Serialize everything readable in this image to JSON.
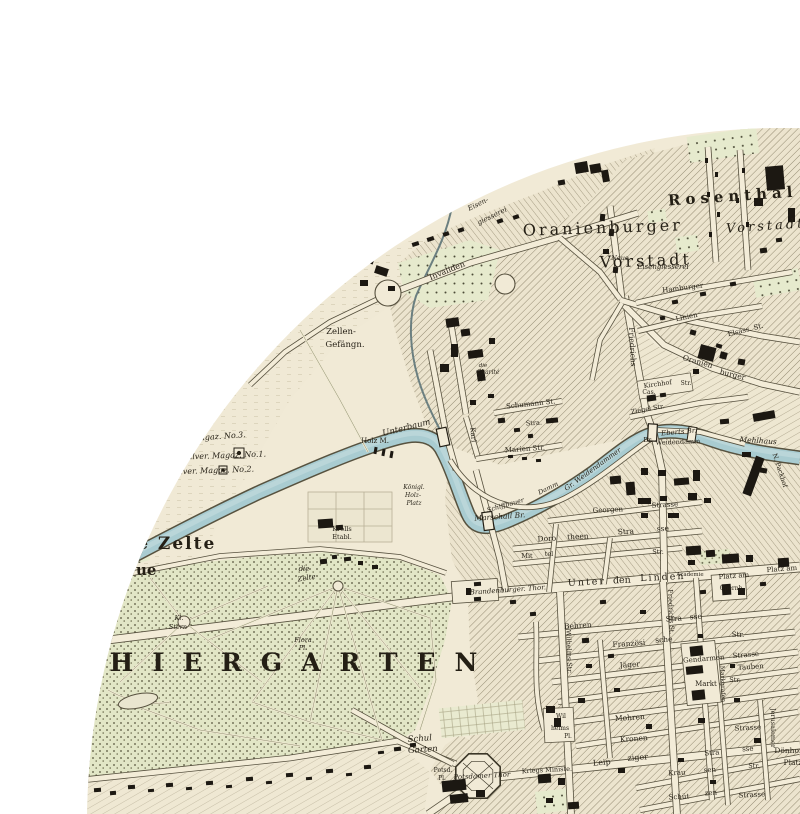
{
  "map": {
    "kind": "historical-city-map-circular-crop",
    "colors": {
      "paper": "#f1ead6",
      "ink": "#241f15",
      "water": "#a9ccd1",
      "water_edge": "#57523f",
      "park_green": "#e2e6c8",
      "hatch": "#847b63",
      "street_fill": "#f3ecd8",
      "street_edge": "#56503e",
      "page_background": "#ffffff"
    },
    "labels": [
      {
        "t": "Rosenthal",
        "x": 733,
        "y": 201,
        "s": 15,
        "r": -4,
        "f": "b",
        "ls": 5
      },
      {
        "t": "Vorstadt",
        "x": 766,
        "y": 230,
        "s": 13,
        "r": -4,
        "f": "i",
        "ls": 3
      },
      {
        "t": "Oranienburger",
        "x": 603,
        "y": 233,
        "s": 16,
        "r": -2,
        "ls": 3
      },
      {
        "t": "Vorstadt",
        "x": 646,
        "y": 266,
        "s": 16,
        "r": -2,
        "ls": 3
      },
      {
        "t": "Neue",
        "x": 620,
        "y": 260,
        "s": 6.5,
        "f": "i"
      },
      {
        "t": "Eisengiesserei",
        "x": 663,
        "y": 269,
        "s": 7,
        "f": "i"
      },
      {
        "t": "THIERGARTEN",
        "x": 72,
        "y": 671,
        "s": 25,
        "f": "b",
        "ls": 19,
        "a": "s"
      },
      {
        "t": "Die Zelte",
        "x": 112,
        "y": 549,
        "s": 17,
        "f": "b",
        "a": "s",
        "ls": 2
      },
      {
        "t": "ue",
        "x": 136,
        "y": 575,
        "s": 15,
        "f": "b",
        "a": "s"
      },
      {
        "t": "die",
        "x": 304,
        "y": 571,
        "s": 7,
        "f": "i"
      },
      {
        "t": "Zelte",
        "x": 307,
        "y": 580,
        "s": 7,
        "f": "i",
        "r": -10
      },
      {
        "t": "Zellen-",
        "x": 341,
        "y": 334,
        "s": 8.5
      },
      {
        "t": "Gefängn.",
        "x": 345,
        "y": 347,
        "s": 8.5
      },
      {
        "t": "Eisen-",
        "x": 479,
        "y": 206,
        "s": 7,
        "f": "i",
        "r": -26
      },
      {
        "t": "giesserei",
        "x": 493,
        "y": 218,
        "s": 7,
        "f": "i",
        "r": -26
      },
      {
        "t": "Invaliden",
        "x": 448,
        "y": 273,
        "s": 8,
        "r": -22
      },
      {
        "t": "Magaz. No.3.",
        "x": 219,
        "y": 439,
        "s": 8,
        "f": "i",
        "r": -4
      },
      {
        "t": "Pulver. Magaz. No.1.",
        "x": 224,
        "y": 458,
        "s": 8,
        "f": "i",
        "r": -2
      },
      {
        "t": "Pulver. Magaz. No.2.",
        "x": 212,
        "y": 473,
        "s": 8,
        "f": "i",
        "r": -2
      },
      {
        "t": "Unterbaum",
        "x": 407,
        "y": 430,
        "s": 8.5,
        "f": "i",
        "r": -14
      },
      {
        "t": "Holz M.",
        "x": 375,
        "y": 443,
        "s": 7
      },
      {
        "t": "Königl.",
        "x": 414,
        "y": 489,
        "s": 6,
        "f": "i"
      },
      {
        "t": "Holz-",
        "x": 413,
        "y": 497,
        "s": 6,
        "f": "i"
      },
      {
        "t": "Platz",
        "x": 414,
        "y": 505,
        "s": 6,
        "f": "i"
      },
      {
        "t": "Marschall Br.",
        "x": 500,
        "y": 519,
        "s": 7.5,
        "f": "i",
        "r": -4
      },
      {
        "t": "Krolls",
        "x": 342,
        "y": 531,
        "s": 6.5
      },
      {
        "t": "Etabl.",
        "x": 342,
        "y": 539,
        "s": 6.5
      },
      {
        "t": "Kl.",
        "x": 179,
        "y": 620,
        "s": 6.5,
        "f": "i"
      },
      {
        "t": "Stern",
        "x": 178,
        "y": 629,
        "s": 6.5,
        "f": "i"
      },
      {
        "t": "Flora",
        "x": 303,
        "y": 642,
        "s": 6.5,
        "f": "i"
      },
      {
        "t": "Pl.",
        "x": 303,
        "y": 650,
        "s": 6.5,
        "f": "i"
      },
      {
        "t": "Schul",
        "x": 420,
        "y": 741,
        "s": 8.5,
        "f": "i",
        "r": -4
      },
      {
        "t": "Garten",
        "x": 423,
        "y": 752,
        "s": 8.5,
        "f": "i",
        "r": -4
      },
      {
        "t": "Potsdamer Thor",
        "x": 482,
        "y": 778,
        "s": 7,
        "f": "i",
        "r": -3
      },
      {
        "t": "Potsd.",
        "x": 443,
        "y": 772,
        "s": 6
      },
      {
        "t": "Pl.",
        "x": 442,
        "y": 780,
        "s": 6
      },
      {
        "t": "Leip",
        "x": 602,
        "y": 765,
        "s": 8,
        "r": -5
      },
      {
        "t": "ziger",
        "x": 638,
        "y": 760,
        "s": 8,
        "r": -5
      },
      {
        "t": "Stra",
        "x": 712,
        "y": 755,
        "s": 7,
        "r": -4
      },
      {
        "t": "sse",
        "x": 748,
        "y": 751,
        "s": 7,
        "r": -4
      },
      {
        "t": "Krau",
        "x": 677,
        "y": 775,
        "s": 7,
        "r": -3
      },
      {
        "t": "sen",
        "x": 710,
        "y": 772,
        "s": 7,
        "r": -3
      },
      {
        "t": "Str.",
        "x": 754,
        "y": 768,
        "s": 6.5
      },
      {
        "t": "Schüt",
        "x": 679,
        "y": 799,
        "s": 7,
        "r": -3
      },
      {
        "t": "zen",
        "x": 711,
        "y": 795,
        "s": 7,
        "r": -3
      },
      {
        "t": "Strasse",
        "x": 752,
        "y": 797,
        "s": 7,
        "r": -3
      },
      {
        "t": "Dönhofs",
        "x": 790,
        "y": 753,
        "s": 7.5
      },
      {
        "t": "Platz",
        "x": 793,
        "y": 765,
        "s": 7.5
      },
      {
        "t": "Jerusalemer",
        "x": 771,
        "y": 728,
        "s": 6.5,
        "r": 90
      },
      {
        "t": "Strasse",
        "x": 748,
        "y": 730,
        "s": 7,
        "r": -3
      },
      {
        "t": "Mohren",
        "x": 630,
        "y": 720,
        "s": 7.5,
        "r": -4
      },
      {
        "t": "Kronen",
        "x": 634,
        "y": 741,
        "s": 7.5,
        "r": -4
      },
      {
        "t": "Wil",
        "x": 561,
        "y": 718,
        "s": 6
      },
      {
        "t": "helms",
        "x": 560,
        "y": 730,
        "s": 6
      },
      {
        "t": "Pl.",
        "x": 568,
        "y": 738,
        "s": 6
      },
      {
        "t": "Kriegs Ministe.",
        "x": 547,
        "y": 772,
        "s": 6.5,
        "r": -3
      },
      {
        "t": "Behren",
        "x": 578,
        "y": 628,
        "s": 7.5,
        "r": -4
      },
      {
        "t": "Stra",
        "x": 674,
        "y": 621,
        "s": 7.5,
        "r": -4
      },
      {
        "t": "sse",
        "x": 696,
        "y": 619,
        "s": 7.5,
        "r": -4
      },
      {
        "t": "Französi",
        "x": 629,
        "y": 646,
        "s": 7.5,
        "r": -4
      },
      {
        "t": "sche",
        "x": 664,
        "y": 642,
        "s": 7.5,
        "r": -4
      },
      {
        "t": "Str.",
        "x": 738,
        "y": 637,
        "s": 7
      },
      {
        "t": "Jäger",
        "x": 630,
        "y": 667,
        "s": 7.5,
        "r": -4
      },
      {
        "t": "Tauben",
        "x": 751,
        "y": 669,
        "s": 7,
        "r": -4
      },
      {
        "t": "Gendarmen",
        "x": 704,
        "y": 661,
        "s": 7,
        "r": -5
      },
      {
        "t": "Strasse",
        "x": 746,
        "y": 657,
        "s": 7,
        "r": -5
      },
      {
        "t": "Markt",
        "x": 706,
        "y": 686,
        "s": 7
      },
      {
        "t": "Str.",
        "x": 735,
        "y": 682,
        "s": 6.5
      },
      {
        "t": "Unter",
        "x": 587,
        "y": 585,
        "s": 9.5,
        "ls": 2,
        "r": -3
      },
      {
        "t": "den",
        "x": 622,
        "y": 583,
        "s": 9.5,
        "r": -3
      },
      {
        "t": "Linden",
        "x": 663,
        "y": 580,
        "s": 9.5,
        "ls": 2,
        "r": -3
      },
      {
        "t": "Brandenburger. Thor.",
        "x": 508,
        "y": 592,
        "s": 7,
        "f": "i",
        "r": -4
      },
      {
        "t": "Platz am",
        "x": 734,
        "y": 578,
        "s": 7,
        "r": -4
      },
      {
        "t": "Opernh.",
        "x": 732,
        "y": 590,
        "s": 6
      },
      {
        "t": "Platz am",
        "x": 782,
        "y": 571,
        "s": 7,
        "r": -4
      },
      {
        "t": "Academie",
        "x": 690,
        "y": 576,
        "s": 5.5
      },
      {
        "t": "Doro",
        "x": 547,
        "y": 541,
        "s": 7.5,
        "r": -3
      },
      {
        "t": "theen",
        "x": 578,
        "y": 539,
        "s": 7.5,
        "r": -3
      },
      {
        "t": "Stra",
        "x": 626,
        "y": 534,
        "s": 7.5,
        "r": -3
      },
      {
        "t": "sse",
        "x": 663,
        "y": 531,
        "s": 7.5,
        "r": -3
      },
      {
        "t": "Mit",
        "x": 527,
        "y": 558,
        "s": 6.5
      },
      {
        "t": "tel",
        "x": 549,
        "y": 556,
        "s": 6.5
      },
      {
        "t": "Str.",
        "x": 658,
        "y": 554,
        "s": 6.5
      },
      {
        "t": "Georgen",
        "x": 608,
        "y": 512,
        "s": 7,
        "r": -3
      },
      {
        "t": "Strasse",
        "x": 665,
        "y": 507,
        "s": 7,
        "r": -3
      },
      {
        "t": "Schumann St.",
        "x": 531,
        "y": 406,
        "s": 7,
        "r": -6
      },
      {
        "t": "die",
        "x": 483,
        "y": 367,
        "s": 5.5,
        "f": "i"
      },
      {
        "t": "Charité",
        "x": 488,
        "y": 374,
        "s": 6,
        "f": "i"
      },
      {
        "t": "Karl",
        "x": 471,
        "y": 435,
        "s": 7,
        "r": 85
      },
      {
        "t": "Stra.",
        "x": 534,
        "y": 425,
        "s": 6.5,
        "r": -4
      },
      {
        "t": "Marien Str.",
        "x": 525,
        "y": 451,
        "s": 7,
        "r": -4
      },
      {
        "t": "Schiffbauer",
        "x": 506,
        "y": 507,
        "s": 6.5,
        "f": "i",
        "r": -16
      },
      {
        "t": "Damm",
        "x": 549,
        "y": 490,
        "s": 6.5,
        "f": "i",
        "r": -26
      },
      {
        "t": "Gr. Weidendammer",
        "x": 594,
        "y": 471,
        "s": 7,
        "f": "i",
        "r": -36
      },
      {
        "t": "Eberts Br.",
        "x": 679,
        "y": 434,
        "s": 7,
        "f": "i",
        "r": -5
      },
      {
        "t": "Br.",
        "x": 648,
        "y": 442,
        "s": 6.5
      },
      {
        "t": "Weidendamm",
        "x": 678,
        "y": 444,
        "s": 6.5,
        "r": -2
      },
      {
        "t": "Mehlhaus",
        "x": 758,
        "y": 443,
        "s": 7.5,
        "f": "i",
        "r": 4
      },
      {
        "t": "N. Packhof",
        "x": 778,
        "y": 471,
        "s": 6.5,
        "r": 72
      },
      {
        "t": "Ziegel Str.",
        "x": 648,
        "y": 411,
        "s": 6.5,
        "r": -10
      },
      {
        "t": "Friedrichs",
        "x": 630,
        "y": 347,
        "s": 7.5,
        "r": 87
      },
      {
        "t": "Friedrichs St.",
        "x": 669,
        "y": 612,
        "s": 6.5,
        "r": 88
      },
      {
        "t": "Wilhelms Str.",
        "x": 567,
        "y": 652,
        "s": 6.5,
        "r": 88
      },
      {
        "t": "Markgrafen",
        "x": 721,
        "y": 684,
        "s": 6,
        "r": 88
      },
      {
        "t": "Linien",
        "x": 687,
        "y": 319,
        "s": 7,
        "r": -12
      },
      {
        "t": "Oranien",
        "x": 697,
        "y": 364,
        "s": 7.5,
        "r": 16
      },
      {
        "t": "burger",
        "x": 732,
        "y": 377,
        "s": 7.5,
        "r": 14
      },
      {
        "t": "Elsass. St.",
        "x": 746,
        "y": 332,
        "s": 7,
        "r": -14
      },
      {
        "t": "Kirchhof",
        "x": 658,
        "y": 386,
        "s": 6.5,
        "r": -8
      },
      {
        "t": "Str.",
        "x": 686,
        "y": 385,
        "s": 6
      },
      {
        "t": "Cas.",
        "x": 649,
        "y": 394,
        "s": 6
      },
      {
        "t": "Hamburger",
        "x": 683,
        "y": 290,
        "s": 7,
        "r": -7
      }
    ]
  }
}
